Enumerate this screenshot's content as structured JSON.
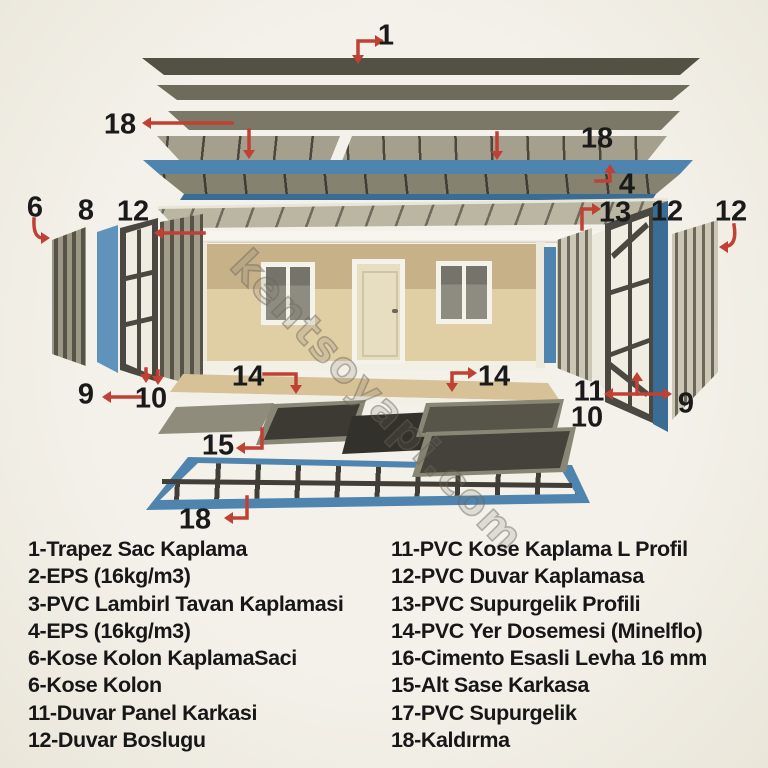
{
  "watermark": "kentsoyapi.com",
  "colors": {
    "background": "#f3f0e9",
    "accent_red": "#c04134",
    "frame_blue": "#4e84ae",
    "panel_dark_olive": "#535144",
    "wall_tan_upper": "#c6b189",
    "wall_tan_lower": "#e0cfa5",
    "legend_text": "#171717"
  },
  "diagram": {
    "callouts": [
      "1",
      "18",
      "18",
      "4",
      "13",
      "6",
      "8",
      "12",
      "12",
      "12",
      "9",
      "10",
      "14",
      "14",
      "11",
      "10",
      "9",
      "15",
      "18"
    ]
  },
  "legend": {
    "left": [
      "1-Trapez Sac Kaplama",
      "2-EPS (16kg/m3)",
      "3-PVC Lambirl Tavan Kaplamasi",
      "4-EPS (16kg/m3)",
      "6-Kose Kolon KaplamaSaci",
      "6-Kose Kolon",
      "11-Duvar Panel Karkasi",
      "12-Duvar Boslugu"
    ],
    "right": [
      "11-PVC Kose Kaplama L Profil",
      "12-PVC Duvar Kaplamasa",
      "13-PVC Supurgelik Profili",
      "14-PVC Yer Dosemesi (Minelflo)",
      "16-Cimento Esasli Levha 16 mm",
      "15-Alt Sase Karkasa",
      "17-PVC Supurgelik",
      "18-Kaldırma"
    ]
  }
}
